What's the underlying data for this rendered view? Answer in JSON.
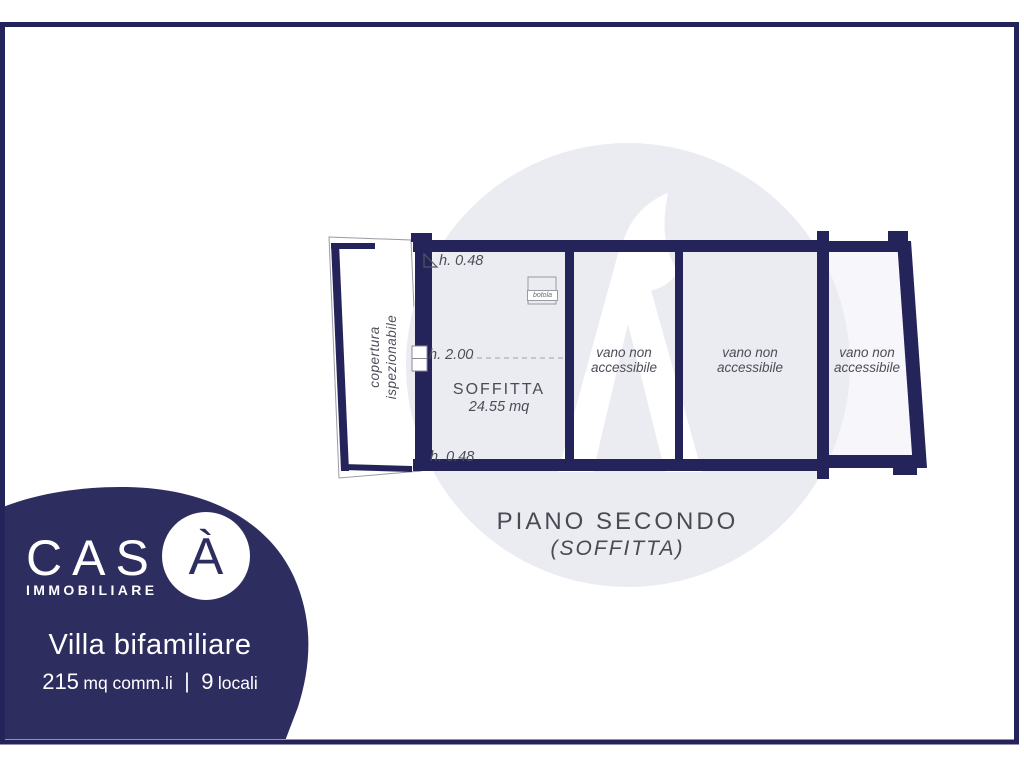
{
  "brand": {
    "logo_text": "CAS",
    "logo_accent": "À",
    "tagline": "IMMOBILIARE"
  },
  "listing": {
    "title": "Villa bifamiliare",
    "area_value": "215",
    "area_unit": "mq comm.li",
    "separator": "|",
    "rooms_value": "9",
    "rooms_unit": "locali"
  },
  "plan": {
    "title": "PIANO SECONDO",
    "subtitle": "(SOFFITTA)",
    "soffitta": {
      "name": "SOFFITTA",
      "area": "24.55 mq"
    },
    "heights": {
      "top": "h. 0.48",
      "middle": "h. 2.00",
      "bottom": "h. 0.48"
    },
    "vani": [
      {
        "line1": "vano non",
        "line2": "accessibile"
      },
      {
        "line1": "vano non",
        "line2": "accessibile"
      },
      {
        "line1": "vano non",
        "line2": "accessibile"
      }
    ],
    "copertura": {
      "line1": "copertura",
      "line2": "ispezionabile"
    },
    "botola": {
      "label": "botola"
    }
  },
  "colors": {
    "navy_wall": "#25245A",
    "navy_bubble": "#2E2D5F",
    "room_fill": "#EFEEF6",
    "room_fill_light": "#F7F7FB",
    "watermark": "#EBEBF2",
    "label_text": "#4D4D5A",
    "title_text": "#4A4A53"
  }
}
